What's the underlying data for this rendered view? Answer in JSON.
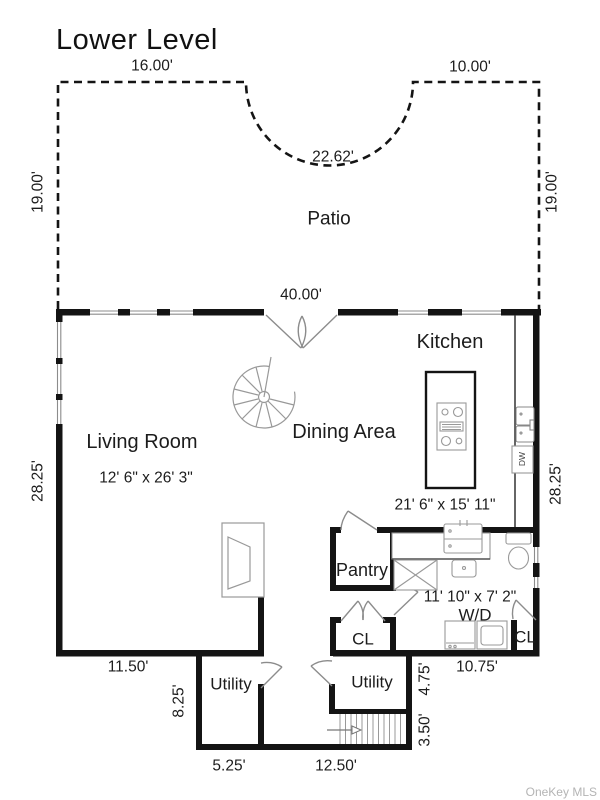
{
  "title": "Lower Level",
  "watermark": "OneKey MLS",
  "rooms": {
    "patio": "Patio",
    "living_room": "Living Room",
    "living_room_size": "12' 6\" x 26' 3\"",
    "dining_area": "Dining Area",
    "kitchen": "Kitchen",
    "kitchen_size": "21' 6\" x 15' 11\"",
    "pantry": "Pantry",
    "laundry_bath_size": "11' 10\" x 7' 2\"",
    "washer_dryer": "W/D",
    "closet_left": "CL",
    "closet_right": "CL",
    "utility_left": "Utility",
    "utility_center": "Utility",
    "dishwasher": "DW"
  },
  "dimensions": {
    "patio_top_left": "16.00'",
    "patio_top_right": "10.00'",
    "patio_arc": "22.62'",
    "patio_side_left": "19.00'",
    "patio_side_right": "19.00'",
    "main_width_top": "40.00'",
    "main_height_left": "28.25'",
    "main_height_right": "28.25'",
    "living_bottom_width": "11.50'",
    "utility_left_height": "8.25'",
    "utility_left_width": "5.25'",
    "stair_hall_width": "12.50'",
    "utility_center_height": "4.75'",
    "stairs_height": "3.50'",
    "laundry_bottom_width": "10.75'"
  },
  "colors": {
    "wall": "#141414",
    "fixture_line": "#949494",
    "text": "#1c1c1c",
    "watermark": "#b4b4b4",
    "background": "#ffffff"
  }
}
